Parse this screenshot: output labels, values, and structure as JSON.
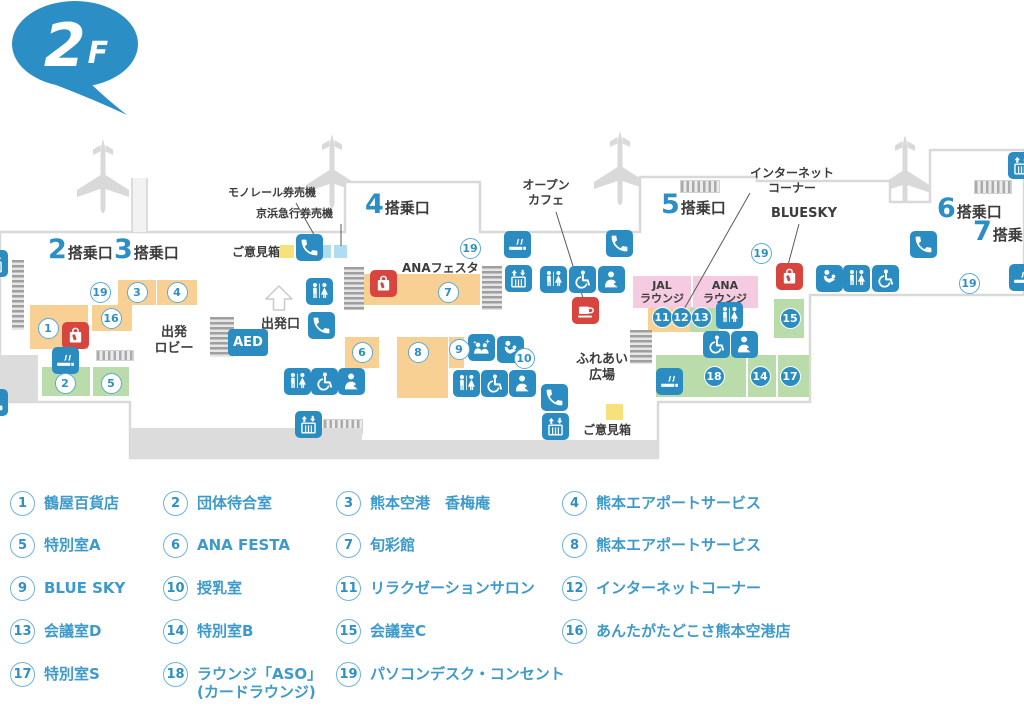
{
  "floor_badge": {
    "number": "2",
    "suffix": "F"
  },
  "map": {
    "gate_suffix": "搭乗口",
    "gates": [
      {
        "number": "2",
        "x": 48,
        "y": 234
      },
      {
        "number": "3",
        "x": 114,
        "y": 234
      },
      {
        "number": "4",
        "x": 365,
        "y": 189
      },
      {
        "number": "5",
        "x": 661,
        "y": 189
      },
      {
        "number": "6",
        "x": 937,
        "y": 193
      },
      {
        "number": "7",
        "x": 973,
        "y": 216
      }
    ],
    "planes": [
      {
        "x": 71,
        "y": 131
      },
      {
        "x": 300,
        "y": 126
      },
      {
        "x": 588,
        "y": 123
      },
      {
        "x": 873,
        "y": 127
      }
    ],
    "zones": [
      {
        "color": "orange",
        "x": 30,
        "y": 305,
        "w": 58,
        "h": 44
      },
      {
        "color": "orange",
        "x": 118,
        "y": 280,
        "w": 38,
        "h": 25
      },
      {
        "color": "orange",
        "x": 157,
        "y": 280,
        "w": 40,
        "h": 25
      },
      {
        "color": "orange",
        "x": 92,
        "y": 305,
        "w": 40,
        "h": 26
      },
      {
        "color": "orange",
        "x": 345,
        "y": 274,
        "w": 135,
        "h": 31
      },
      {
        "color": "orange",
        "x": 345,
        "y": 337,
        "w": 34,
        "h": 31
      },
      {
        "color": "orange",
        "x": 397,
        "y": 337,
        "w": 51,
        "h": 61
      },
      {
        "color": "orange",
        "x": 449,
        "y": 337,
        "w": 15,
        "h": 31
      },
      {
        "color": "orange",
        "x": 648,
        "y": 307,
        "w": 42,
        "h": 25
      },
      {
        "color": "green",
        "x": 42,
        "y": 367,
        "w": 48,
        "h": 29
      },
      {
        "color": "green",
        "x": 93,
        "y": 367,
        "w": 36,
        "h": 29
      },
      {
        "color": "green",
        "x": 690,
        "y": 307,
        "w": 29,
        "h": 25
      },
      {
        "color": "green",
        "x": 774,
        "y": 299,
        "w": 30,
        "h": 39
      },
      {
        "color": "green",
        "x": 656,
        "y": 355,
        "w": 90,
        "h": 42
      },
      {
        "color": "green",
        "x": 748,
        "y": 355,
        "w": 28,
        "h": 42
      },
      {
        "color": "green",
        "x": 778,
        "y": 355,
        "w": 31,
        "h": 42
      },
      {
        "color": "pink",
        "x": 633,
        "y": 276,
        "w": 58,
        "h": 32
      },
      {
        "color": "pink",
        "x": 693,
        "y": 276,
        "w": 65,
        "h": 32
      },
      {
        "color": "yellow",
        "x": 280,
        "y": 245,
        "w": 14,
        "h": 13
      },
      {
        "color": "yellow",
        "x": 606,
        "y": 404,
        "w": 17,
        "h": 16
      },
      {
        "color": "lightblue",
        "x": 318,
        "y": 245,
        "w": 13,
        "h": 13
      },
      {
        "color": "lightblue",
        "x": 334,
        "y": 245,
        "w": 13,
        "h": 13
      }
    ],
    "structures": [
      {
        "type": "stairs-v",
        "x": 12,
        "y": 260,
        "w": 12,
        "h": 70
      },
      {
        "type": "stairs-v",
        "x": 210,
        "y": 317,
        "w": 24,
        "h": 40
      },
      {
        "type": "stairs-v",
        "x": 344,
        "y": 267,
        "w": 20,
        "h": 43
      },
      {
        "type": "stairs-v",
        "x": 482,
        "y": 266,
        "w": 20,
        "h": 44
      },
      {
        "type": "stairs-v",
        "x": 630,
        "y": 330,
        "w": 22,
        "h": 34
      },
      {
        "type": "hatch-h",
        "x": 96,
        "y": 350,
        "w": 36,
        "h": 9
      },
      {
        "type": "hatch-h",
        "x": 323,
        "y": 419,
        "w": 38,
        "h": 13
      },
      {
        "type": "hatch-h",
        "x": 680,
        "y": 180,
        "w": 38,
        "h": 11
      },
      {
        "type": "hatch-h",
        "x": 974,
        "y": 180,
        "w": 36,
        "h": 12
      },
      {
        "type": "gray-rect",
        "x": 0,
        "y": 355,
        "w": 38,
        "h": 46
      },
      {
        "type": "gray-rect",
        "x": 130,
        "y": 428,
        "w": 232,
        "h": 30
      },
      {
        "type": "gray-rect",
        "x": 360,
        "y": 440,
        "w": 298,
        "h": 18
      },
      {
        "type": "corridor",
        "x": 131,
        "y": 178,
        "w": 13,
        "h": 54
      }
    ],
    "icons": [
      {
        "type": "phone",
        "x": 296,
        "y": 234
      },
      {
        "type": "smoking",
        "x": 504,
        "y": 231
      },
      {
        "type": "phone",
        "x": 606,
        "y": 230
      },
      {
        "type": "elevator",
        "x": 505,
        "y": 265
      },
      {
        "type": "restroom",
        "x": 540,
        "y": 266
      },
      {
        "type": "wheelchair",
        "x": 569,
        "y": 266
      },
      {
        "type": "staff",
        "x": 598,
        "y": 266
      },
      {
        "type": "cafe",
        "x": 572,
        "y": 297,
        "red": true
      },
      {
        "type": "restroom",
        "x": 306,
        "y": 278
      },
      {
        "type": "phone",
        "x": 308,
        "y": 312
      },
      {
        "type": "shop",
        "x": 62,
        "y": 322,
        "red": true
      },
      {
        "type": "smoking",
        "x": 52,
        "y": 347
      },
      {
        "type": "shop",
        "x": 370,
        "y": 270,
        "red": true
      },
      {
        "type": "restroom",
        "x": 284,
        "y": 368
      },
      {
        "type": "wheelchair",
        "x": 311,
        "y": 368
      },
      {
        "type": "staff",
        "x": 338,
        "y": 368
      },
      {
        "type": "escalator",
        "x": 295,
        "y": 411
      },
      {
        "type": "kids-space",
        "x": 468,
        "y": 334
      },
      {
        "type": "baby",
        "x": 497,
        "y": 336
      },
      {
        "type": "restroom",
        "x": 453,
        "y": 370
      },
      {
        "type": "wheelchair",
        "x": 481,
        "y": 370
      },
      {
        "type": "staff",
        "x": 509,
        "y": 370
      },
      {
        "type": "phone",
        "x": 541,
        "y": 384
      },
      {
        "type": "elevator",
        "x": 542,
        "y": 413
      },
      {
        "type": "restroom",
        "x": 716,
        "y": 302
      },
      {
        "type": "wheelchair",
        "x": 703,
        "y": 331
      },
      {
        "type": "staff",
        "x": 731,
        "y": 331
      },
      {
        "type": "smoking",
        "x": 656,
        "y": 368
      },
      {
        "type": "shop",
        "x": 776,
        "y": 263,
        "red": true
      },
      {
        "type": "baby",
        "x": 816,
        "y": 265
      },
      {
        "type": "restroom",
        "x": 843,
        "y": 265
      },
      {
        "type": "wheelchair",
        "x": 872,
        "y": 265
      },
      {
        "type": "phone",
        "x": 910,
        "y": 231
      },
      {
        "type": "elevator",
        "x": 1008,
        "y": 152
      },
      {
        "type": "smoking",
        "x": 1009,
        "y": 264
      },
      {
        "type": "elevator",
        "x": -19,
        "y": 250
      },
      {
        "type": "phone",
        "x": -19,
        "y": 389
      }
    ],
    "aed": {
      "label": "AED",
      "x": 228,
      "y": 329,
      "w": 40,
      "h": 27
    },
    "markers": [
      {
        "n": "19",
        "x": 100,
        "y": 292,
        "style": "w"
      },
      {
        "n": "3",
        "x": 137,
        "y": 292,
        "style": "w"
      },
      {
        "n": "4",
        "x": 177,
        "y": 292,
        "style": "w"
      },
      {
        "n": "16",
        "x": 111,
        "y": 318,
        "style": "w"
      },
      {
        "n": "1",
        "x": 48,
        "y": 328,
        "style": "w"
      },
      {
        "n": "2",
        "x": 65,
        "y": 383,
        "style": "w"
      },
      {
        "n": "5",
        "x": 111,
        "y": 383,
        "style": "w"
      },
      {
        "n": "19",
        "x": 470,
        "y": 248,
        "style": "w"
      },
      {
        "n": "7",
        "x": 448,
        "y": 292,
        "style": "w"
      },
      {
        "n": "6",
        "x": 362,
        "y": 352,
        "style": "w"
      },
      {
        "n": "8",
        "x": 418,
        "y": 352,
        "style": "w"
      },
      {
        "n": "9",
        "x": 459,
        "y": 349,
        "style": "w"
      },
      {
        "n": "10",
        "x": 524,
        "y": 358,
        "style": "w"
      },
      {
        "n": "19",
        "x": 761,
        "y": 253,
        "style": "w"
      },
      {
        "n": "11",
        "x": 662,
        "y": 317,
        "style": "b"
      },
      {
        "n": "12",
        "x": 681,
        "y": 317,
        "style": "b"
      },
      {
        "n": "13",
        "x": 701,
        "y": 317,
        "style": "b"
      },
      {
        "n": "15",
        "x": 790,
        "y": 318,
        "style": "b"
      },
      {
        "n": "18",
        "x": 714,
        "y": 376,
        "style": "b"
      },
      {
        "n": "14",
        "x": 760,
        "y": 376,
        "style": "b"
      },
      {
        "n": "17",
        "x": 790,
        "y": 376,
        "style": "b"
      },
      {
        "n": "19",
        "x": 969,
        "y": 283,
        "style": "w"
      }
    ],
    "texts": [
      {
        "t": "モノレール券売機",
        "x": 228,
        "y": 186,
        "s": 11
      },
      {
        "t": "京浜急行券売機",
        "x": 256,
        "y": 207,
        "s": 11
      },
      {
        "t": "ご意見箱",
        "x": 232,
        "y": 245,
        "s": 12
      },
      {
        "t": "オープン\nカフェ",
        "x": 512,
        "y": 178,
        "s": 12,
        "c": 1,
        "w": 68
      },
      {
        "t": "インターネット\nコーナー",
        "x": 748,
        "y": 166,
        "s": 12,
        "c": 1,
        "w": 88
      },
      {
        "t": "BLUESKY",
        "x": 771,
        "y": 206,
        "s": 13
      },
      {
        "t": "出発\nロビー",
        "x": 152,
        "y": 325,
        "s": 13,
        "c": 1,
        "w": 44
      },
      {
        "t": "出発口",
        "x": 261,
        "y": 317,
        "s": 13
      },
      {
        "t": "ANAフェスタ",
        "x": 402,
        "y": 261,
        "s": 12
      },
      {
        "t": "JAL\nラウンジ",
        "x": 635,
        "y": 279,
        "s": 11,
        "c": 1,
        "w": 54
      },
      {
        "t": "ANA\nラウンジ",
        "x": 694,
        "y": 279,
        "s": 11,
        "c": 1,
        "w": 62
      },
      {
        "t": "ふれあい\n広場",
        "x": 566,
        "y": 352,
        "s": 13,
        "c": 1,
        "w": 72
      },
      {
        "t": "ご意見箱",
        "x": 583,
        "y": 423,
        "s": 12
      }
    ],
    "pointer_lines": [
      {
        "x1": 296,
        "y1": 203,
        "x2": 320,
        "y2": 245
      },
      {
        "x1": 341,
        "y1": 224,
        "x2": 341,
        "y2": 246
      },
      {
        "x1": 556,
        "y1": 212,
        "x2": 584,
        "y2": 301
      },
      {
        "x1": 750,
        "y1": 193,
        "x2": 683,
        "y2": 311
      },
      {
        "x1": 799,
        "y1": 224,
        "x2": 788,
        "y2": 265
      }
    ]
  },
  "legend": {
    "col_x": [
      10,
      163,
      336,
      562
    ],
    "row_y": [
      491,
      533,
      576,
      619,
      662
    ],
    "items": [
      {
        "number": "1",
        "label": "鶴屋百貨店",
        "col": 0,
        "row": 0
      },
      {
        "number": "2",
        "label": "団体待合室",
        "col": 1,
        "row": 0
      },
      {
        "number": "3",
        "label": "熊本空港　香梅庵",
        "col": 2,
        "row": 0
      },
      {
        "number": "4",
        "label": "熊本エアポートサービス",
        "col": 3,
        "row": 0
      },
      {
        "number": "5",
        "label": "特別室A",
        "col": 0,
        "row": 1
      },
      {
        "number": "6",
        "label": "ANA FESTA",
        "col": 1,
        "row": 1
      },
      {
        "number": "7",
        "label": "旬彩館",
        "col": 2,
        "row": 1
      },
      {
        "number": "8",
        "label": "熊本エアポートサービス",
        "col": 3,
        "row": 1
      },
      {
        "number": "9",
        "label": "BLUE SKY",
        "col": 0,
        "row": 2
      },
      {
        "number": "10",
        "label": "授乳室",
        "col": 1,
        "row": 2
      },
      {
        "number": "11",
        "label": "リラクゼーションサロン",
        "col": 2,
        "row": 2
      },
      {
        "number": "12",
        "label": "インターネットコーナー",
        "col": 3,
        "row": 2
      },
      {
        "number": "13",
        "label": "会議室D",
        "col": 0,
        "row": 3
      },
      {
        "number": "14",
        "label": "特別室B",
        "col": 1,
        "row": 3
      },
      {
        "number": "15",
        "label": "会議室C",
        "col": 2,
        "row": 3
      },
      {
        "number": "16",
        "label": "あんたがたどこさ熊本空港店",
        "col": 3,
        "row": 3
      },
      {
        "number": "17",
        "label": "特別室S",
        "col": 0,
        "row": 4
      },
      {
        "number": "18",
        "label": "ラウンジ「ASO」\n(カードラウンジ)",
        "col": 1,
        "row": 4
      },
      {
        "number": "19",
        "label": "パソコンデスク・コンセント",
        "col": 2,
        "row": 4
      }
    ]
  },
  "colors": {
    "brand_blue": "#2b8fc5",
    "icon_blue": "#2b8cc2",
    "legend_blue": "#3d9aca",
    "zone_orange": "#f8d093",
    "zone_green": "#b9dcaa",
    "zone_pink": "#f5cbe1",
    "zone_yellow": "#f6e17c",
    "zone_lightblue": "#aedcf2",
    "accent_red": "#d8453e",
    "outline_gray": "#d9d9d9"
  }
}
